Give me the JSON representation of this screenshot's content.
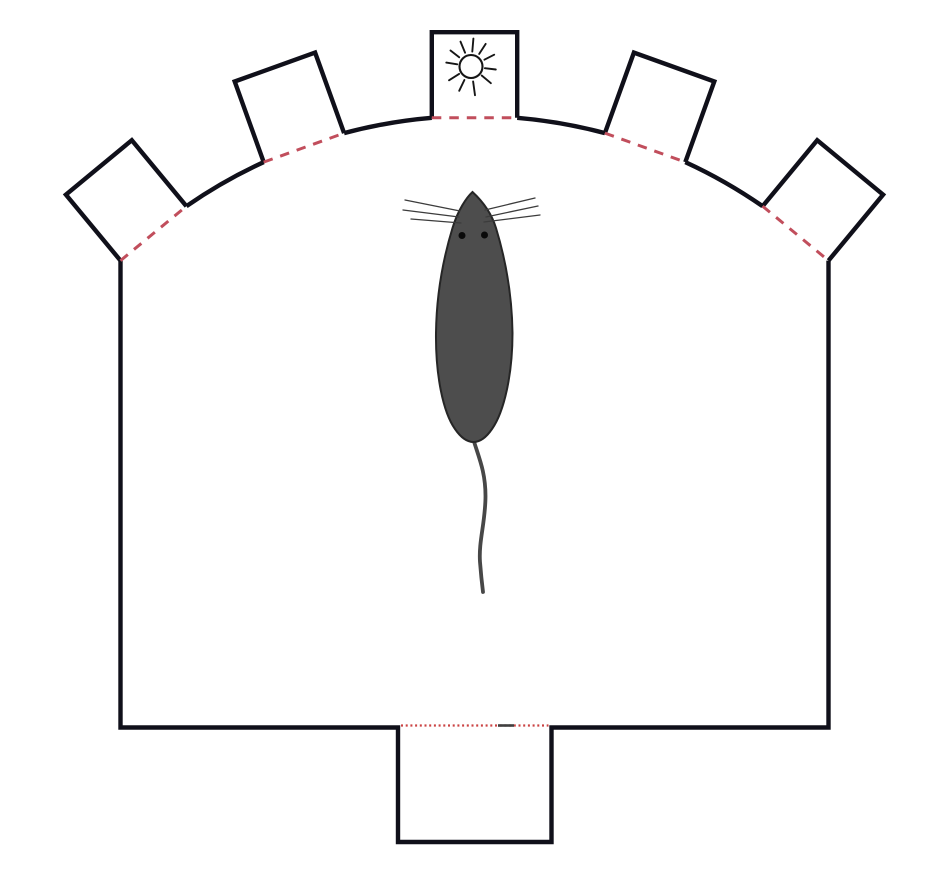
{
  "figure": {
    "description": "Top-view schematic of a dome-shaped mouse arena: five square shelter boxes along the curved top wall, the middle box marked with a sun symbol, red dashed lines marking each shelter entrance, a dark gray mouse in the arena center, and a bottom start box whose entrance is marked by a fine red dotted line.",
    "background_color": "#ffffff"
  },
  "style": {
    "wall_color": "#10101a",
    "wall_width": 4.4,
    "entrance_dash_color": "#c14e5c",
    "entrance_dash_width": 3,
    "entrance_dash_pattern": "9.5 8",
    "start_dot_color": "#cb4343",
    "start_dot_width": 2.2,
    "start_dot_pattern": "2 2.7",
    "start_mark_color": "#3f3f3f",
    "sun_color": "#161616",
    "sun_stroke_width": 2.1,
    "sun_ray_width": 1.9
  },
  "geometry": {
    "canvas": {
      "width": 928,
      "height": 870
    },
    "arc": {
      "cx": 474.5,
      "cy": 621.5,
      "r": 505.5
    },
    "walls": {
      "floor_y": 727.5
    },
    "boxes": {
      "count": 5,
      "center_angles_deg": [
        129.6,
        109.8,
        90,
        70.2,
        50.4
      ],
      "entrance_half_angle_deg": 4.85,
      "side": 85.6,
      "sun_box_index": 2
    },
    "start_box": {
      "left_x": 398,
      "right_x": 551.5,
      "bottom_y": 842,
      "dotted_y": 725.5,
      "dotted_inset": 3,
      "mark_x1": 498,
      "mark_x2": 514
    },
    "sun": {
      "cx": 471,
      "cy": 66.5,
      "disc_r": 11.5,
      "rays": [
        [
          85,
          15,
          28
        ],
        [
          113,
          15,
          27
        ],
        [
          142,
          15,
          26
        ],
        [
          171,
          14,
          25
        ],
        [
          212,
          14,
          26
        ],
        [
          244,
          15,
          27
        ],
        [
          278,
          15,
          29
        ],
        [
          320,
          14,
          26
        ],
        [
          353,
          14,
          25
        ],
        [
          27,
          15,
          26
        ],
        [
          57,
          15,
          27
        ]
      ]
    }
  },
  "mouse": {
    "body_color": "#4d4d4d",
    "outline_color": "#262626",
    "outline_width": 2,
    "eye_color": "#0a0a0a",
    "eye_r": 3.5,
    "eyes": [
      [
        462,
        235.5
      ],
      [
        484.5,
        235
      ]
    ],
    "whisker_color": "#3c3c3c",
    "whisker_width": 1.3,
    "whiskers": [
      [
        460,
        211,
        405,
        200
      ],
      [
        459,
        217,
        403,
        210
      ],
      [
        461,
        223,
        411,
        219
      ],
      [
        485,
        210,
        535,
        198
      ],
      [
        486,
        217,
        538,
        206
      ],
      [
        484,
        222,
        540,
        215
      ]
    ],
    "tail_color": "#474747",
    "tail_width": 3.8,
    "tail_path": "M 473.5 440 C 479 458 485.5 472 485.5 496 C 485.5 522 478.5 541 480 562 C 481 575 482 584 483 592",
    "body_path": "M 472.5 192 C 466.5 197.5 458 210 452.5 228 C 444 256 436.5 293 436 333 C 435.5 375 443 412 455 429 C 461.5 438.5 467.5 442 473.5 442 C 479.5 442 485.5 438.5 492 429 C 504 412 512.5 375 512.5 333 C 512 293 504.5 256 496 228 C 490.5 210 478.5 197.5 472.5 192 Z"
  }
}
